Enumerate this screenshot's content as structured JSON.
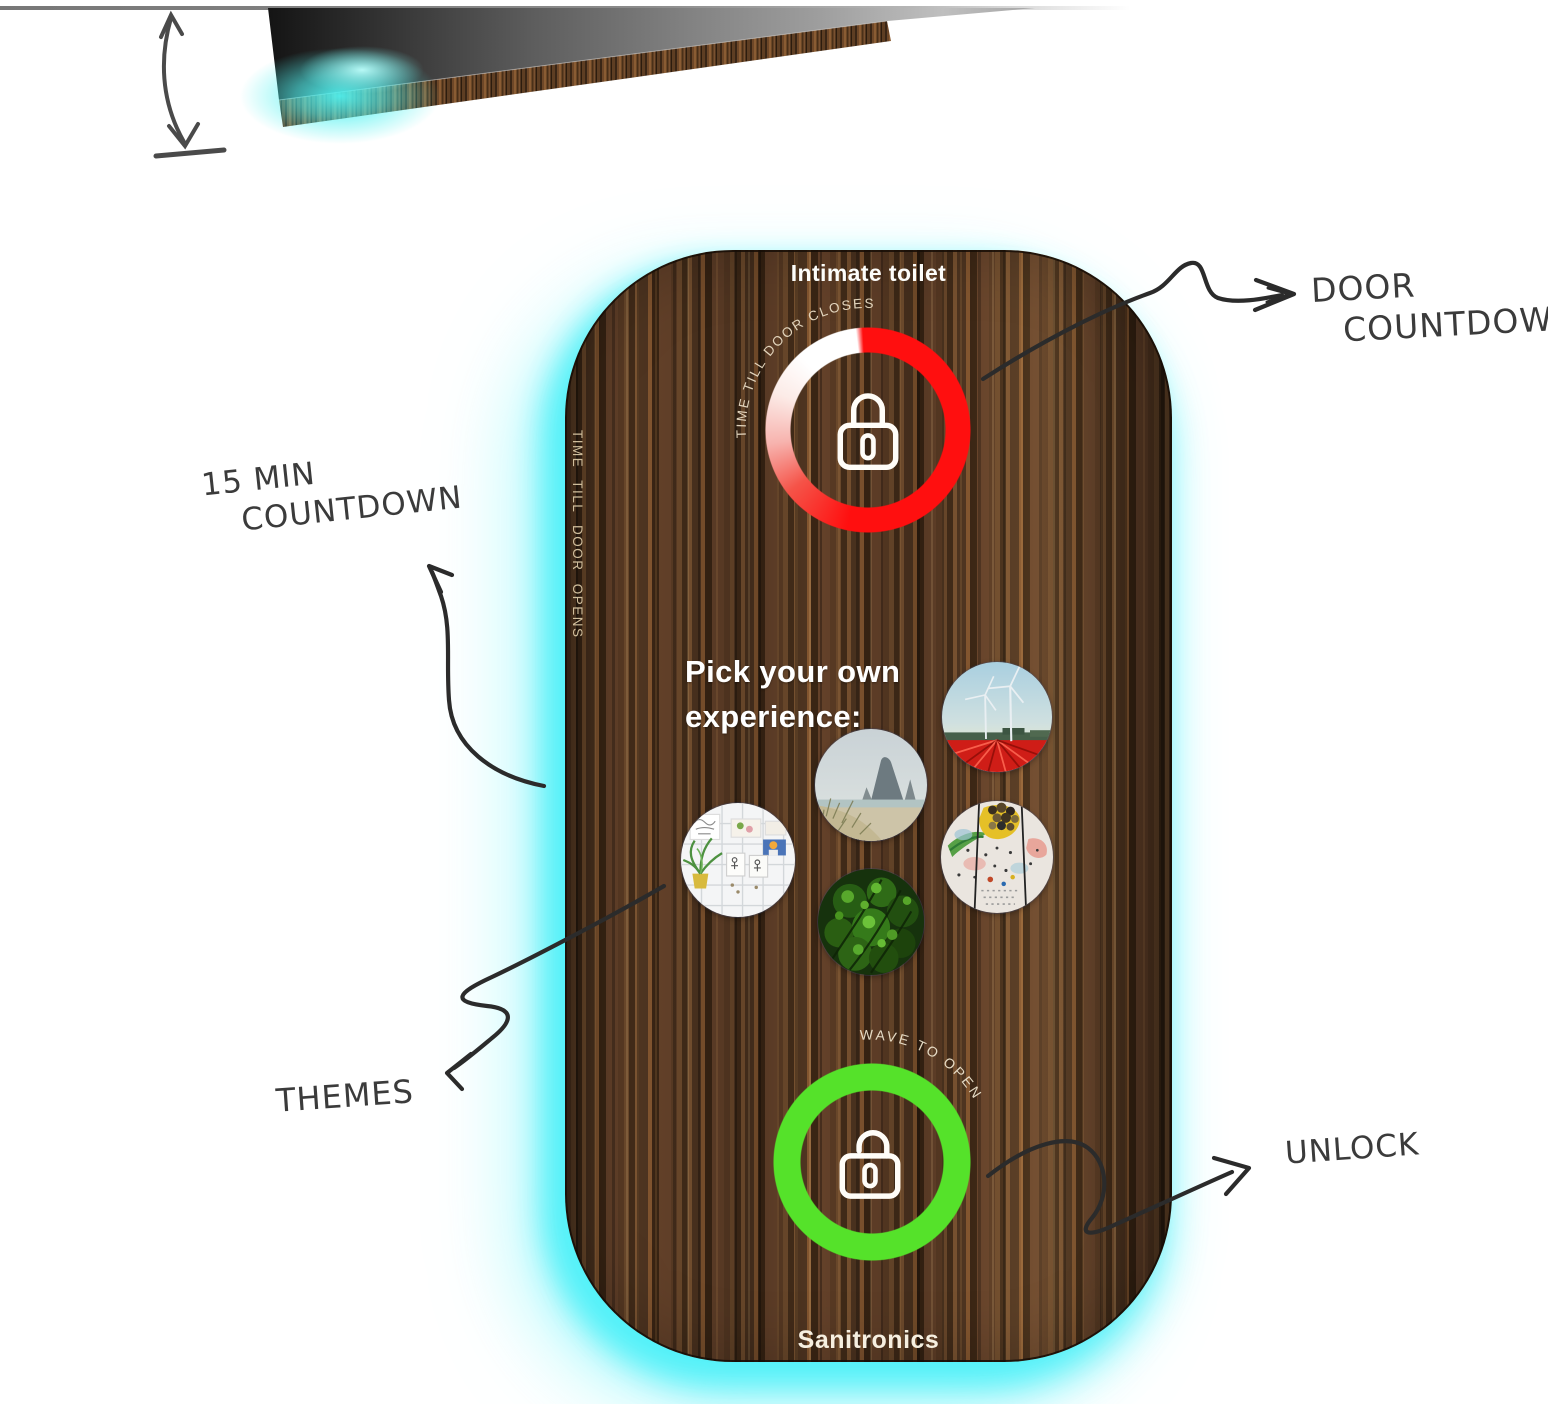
{
  "colors": {
    "edge_glow": "#4df0f4",
    "countdown_ring": "#fa1010",
    "unlock_ring": "#55e22a",
    "wood_dark": "#432c19",
    "wood_light": "#82552f"
  },
  "side_view": {
    "description_icons": [
      "door-slab-top-surface",
      "door-slab-wood-edge",
      "cyan-glow",
      "height-dimension-arrow",
      "ceiling-line"
    ]
  },
  "panel": {
    "title": "Intimate toilet",
    "countdown_ring_label": "TIME TILL DOOR CLOSES",
    "side_label": "TIME TILL DOOR OPENS",
    "experience_heading_line1": "Pick your own",
    "experience_heading_line2": "experience:",
    "themes": [
      "windmills-tulip-field",
      "beach-rock",
      "smile-cartoon-board",
      "art-collage",
      "jungle"
    ],
    "unlock_ring_label": "WAVE TO OPEN",
    "brand": "Sanitronics",
    "icons": [
      "lock-icon",
      "unlock-icon"
    ]
  },
  "annotations": {
    "door_countdown_line1": "DOOR",
    "door_countdown_line2": "COUNTDOWN",
    "min_countdown_line1": "15 MIN",
    "min_countdown_line2": "COUNTDOWN",
    "themes_label": "THEMES",
    "unlock_label": "UNLOCK"
  }
}
